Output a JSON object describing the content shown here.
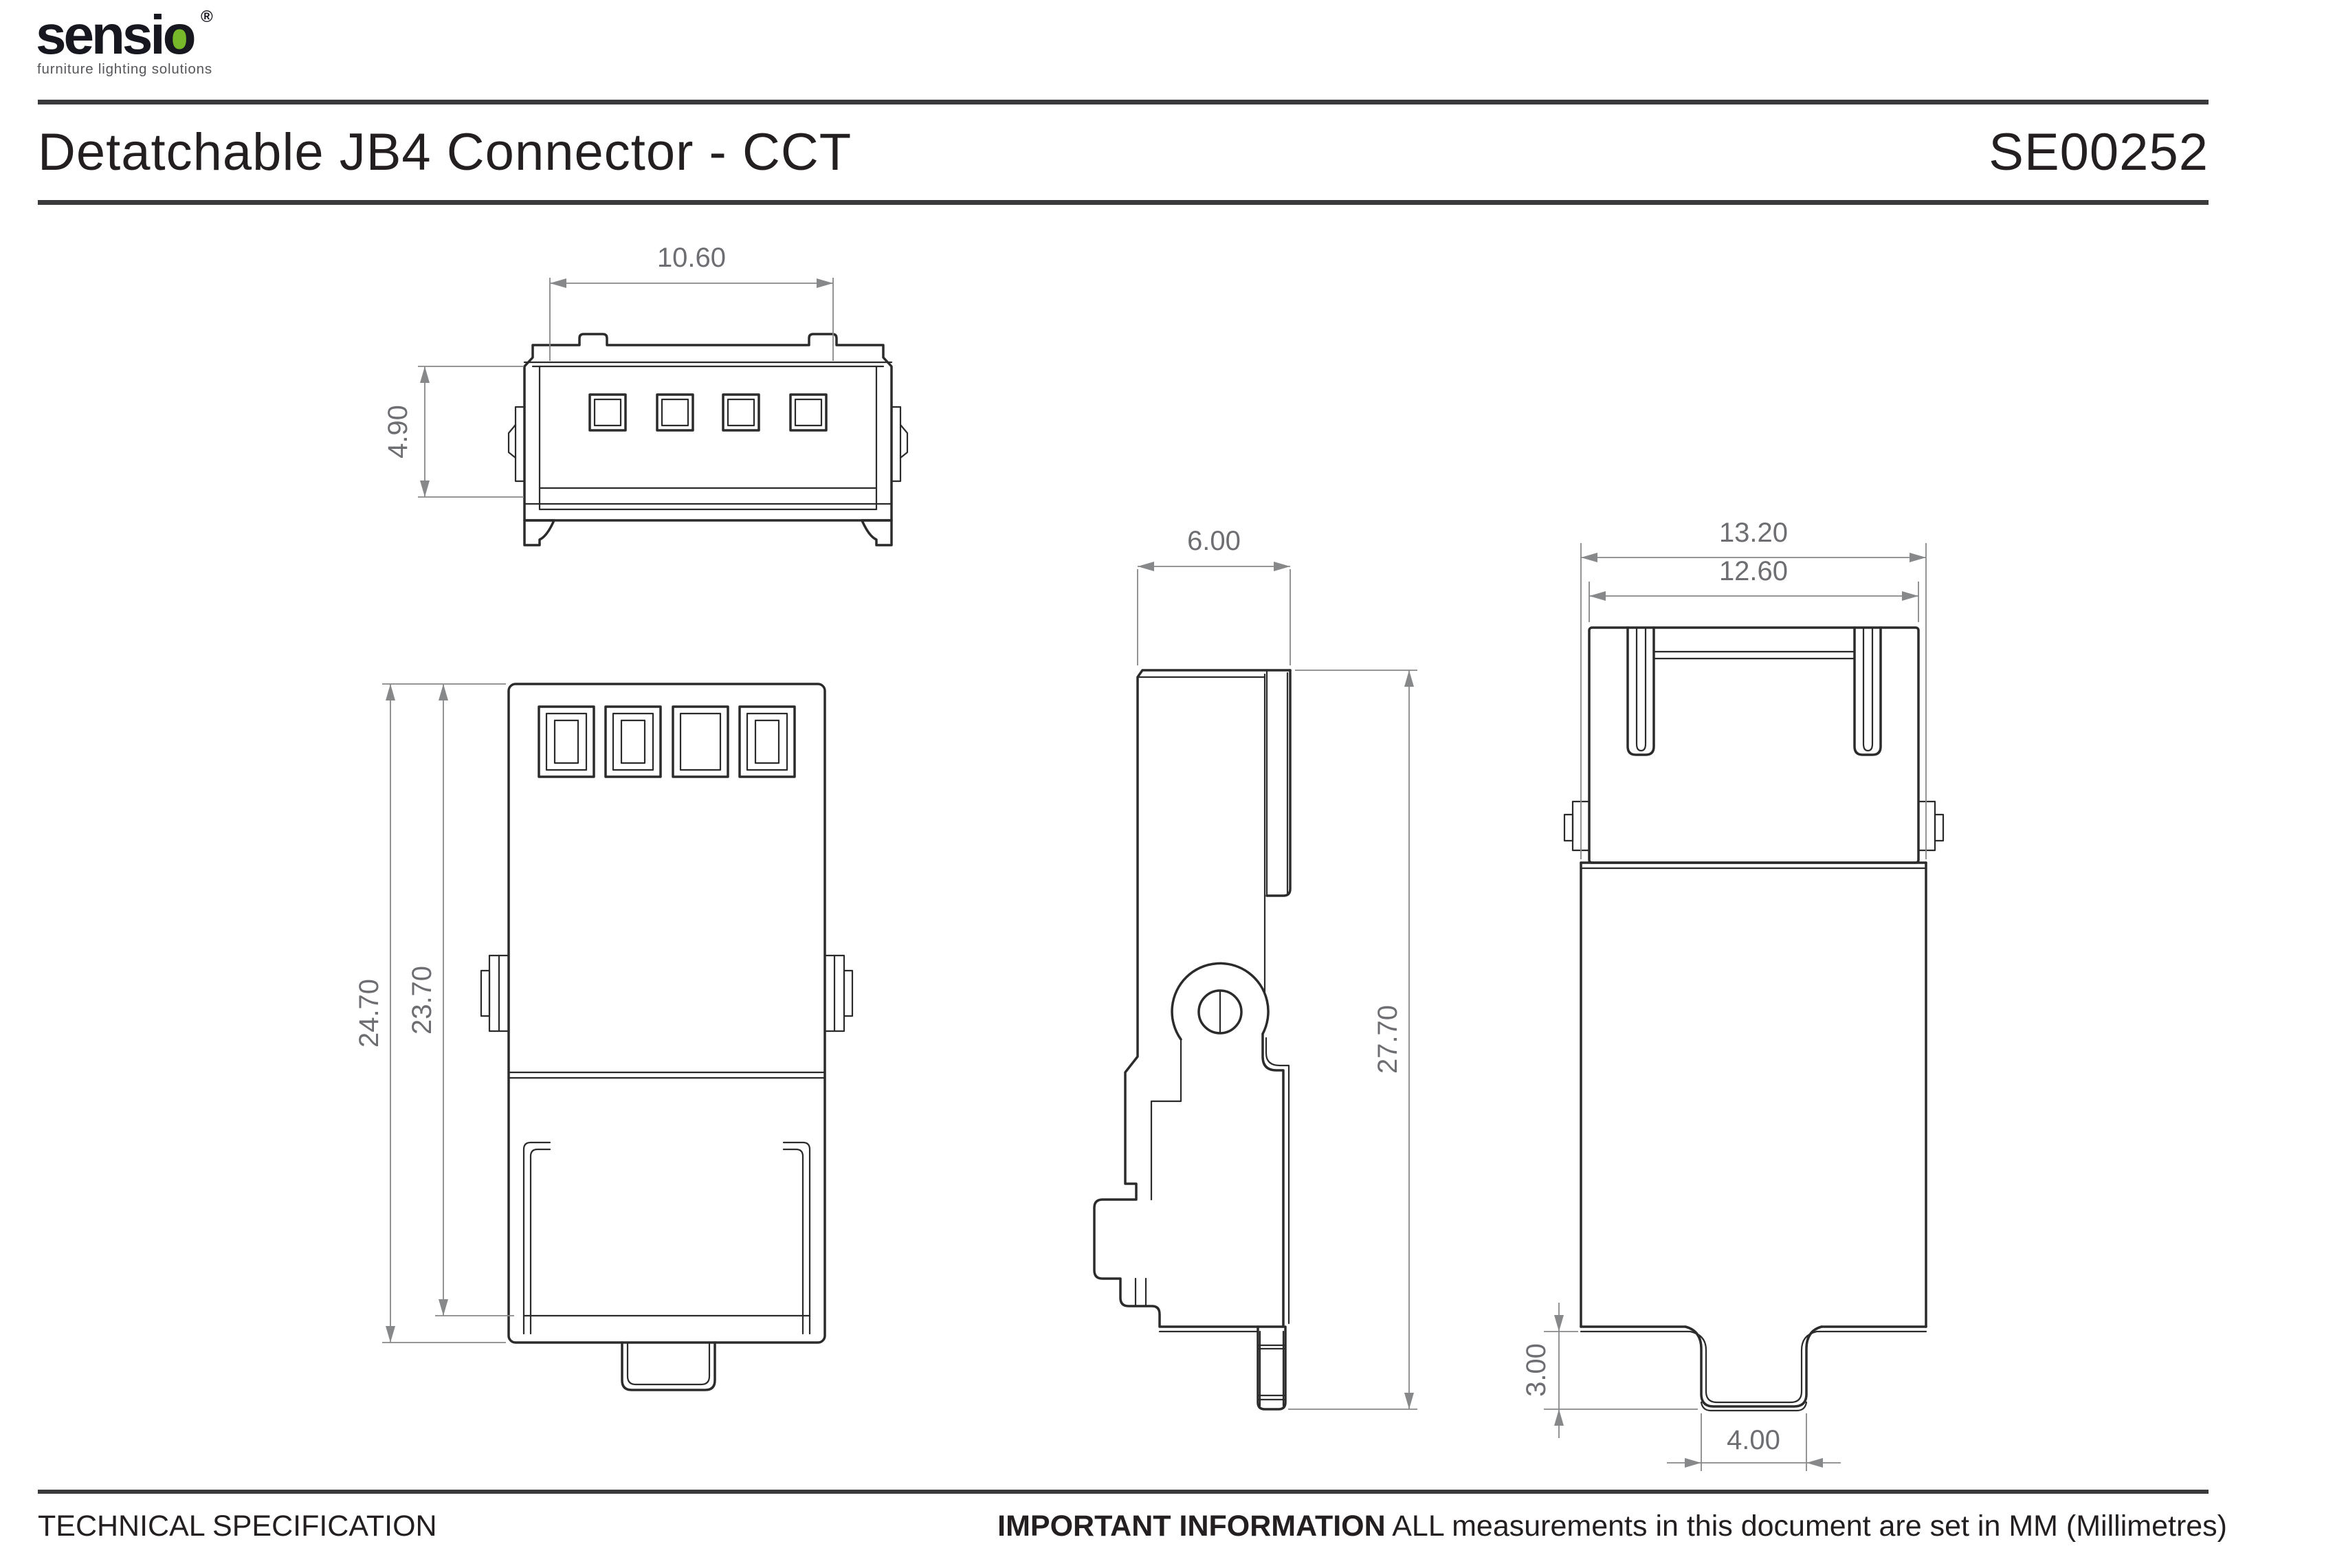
{
  "brand": {
    "wordmark": "sensio",
    "registered_mark": "®",
    "tagline": "furniture lighting solutions",
    "wordmark_color": "#17171f",
    "accent_green": "#76b82a",
    "tagline_color": "#55565a"
  },
  "header": {
    "title": "Detatchable JB4 Connector - CCT",
    "part_number": "SE00252"
  },
  "footer": {
    "left_label": "TECHNICAL SPECIFICATION",
    "important_label": "IMPORTANT INFORMATION",
    "note": " ALL measurements in this document are set in MM (Millimetres)"
  },
  "drawing": {
    "line_color": "#2b2b2b",
    "dimension_line_color": "#87888a",
    "dimension_text_color": "#6d6e71",
    "views": {
      "front_face": {
        "label": "front-face-view",
        "dimensions": {
          "opening_width_mm": "10.60",
          "opening_height_mm": "4.90"
        }
      },
      "front": {
        "label": "front-view",
        "dimensions": {
          "overall_height_mm": "24.70",
          "body_height_mm": "23.70"
        }
      },
      "side": {
        "label": "side-view",
        "dimensions": {
          "depth_mm": "6.00",
          "overall_height_mm": "27.70"
        }
      },
      "rear": {
        "label": "rear-view",
        "dimensions": {
          "overall_width_mm": "13.20",
          "body_width_mm": "12.60",
          "tab_height_mm": "3.00",
          "tab_width_mm": "4.00"
        }
      }
    }
  }
}
